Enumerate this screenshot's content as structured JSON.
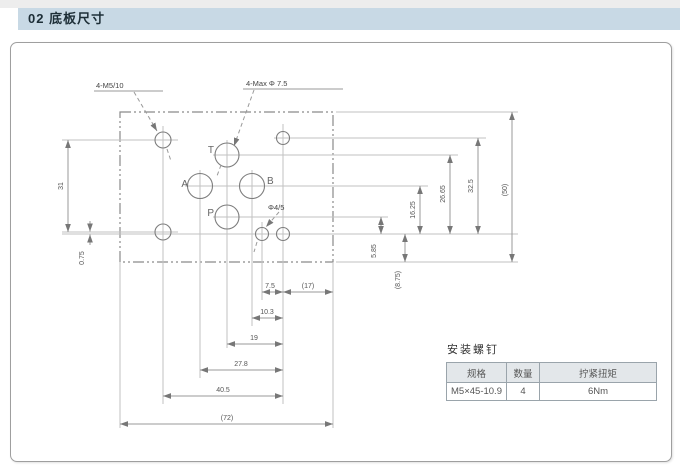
{
  "header": {
    "title": "02 底板尺寸"
  },
  "drawing": {
    "callouts": {
      "mounting_thread": "4-M5/10",
      "max_port_dia": "4-Max Φ 7.5",
      "pin_hole": "Φ4/5"
    },
    "ports": {
      "t": "T",
      "a": "A",
      "b": "B",
      "p": "P"
    },
    "dims": {
      "left_vertical": "31",
      "left_offset": "0.75",
      "right_p_height": "5.85",
      "right_edge_gap": "(8.75)",
      "right_ab_height": "16.25",
      "right_t_height": "26.65",
      "right_bolt_span": "32.5",
      "right_plate_height": "(50)",
      "bottom_pin_to_bolt": "7.5",
      "bottom_to_edge": "(17)",
      "bottom_b_to_bolt": "10.3",
      "bottom_p_to_bolt": "19",
      "bottom_a_to_bolt": "27.8",
      "bottom_bolt_span": "40.5",
      "bottom_plate_width": "(72)"
    }
  },
  "table": {
    "title": "安装螺钉",
    "headers": [
      "规格",
      "数量",
      "拧紧扭矩"
    ],
    "row": [
      "M5×45-10.9",
      "4",
      "6Nm"
    ]
  }
}
